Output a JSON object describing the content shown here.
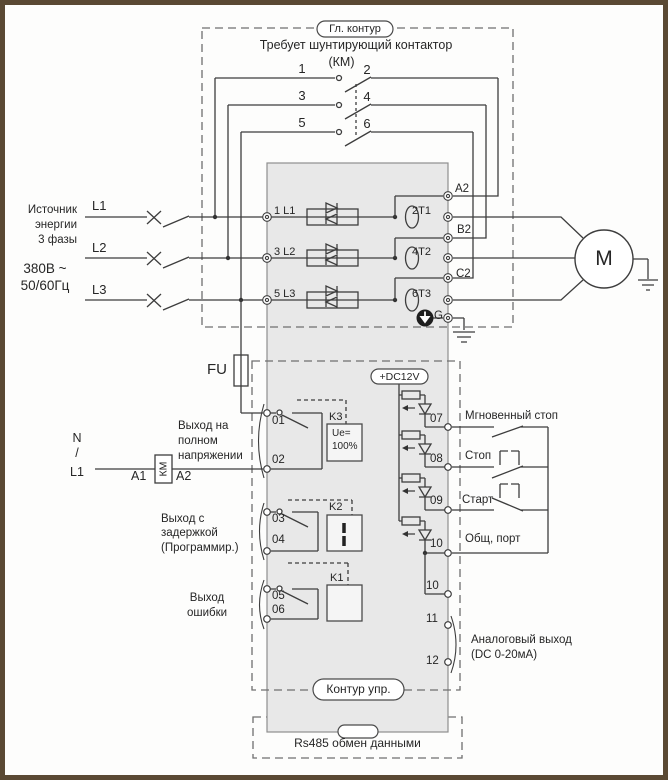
{
  "main_circuit": {
    "pill": "Гл. контур",
    "note1": "Требует шунтирующий контактор",
    "note2": "(КМ)",
    "contacts": [
      "1",
      "2",
      "3",
      "4",
      "5",
      "6"
    ]
  },
  "source": {
    "lines": [
      "Источник",
      "энергии",
      "3 фазы"
    ],
    "voltage": "380В ~",
    "freq": "50/60Гц",
    "phases": [
      "L1",
      "L2",
      "L3"
    ]
  },
  "power": {
    "inputs": [
      "1 L1",
      "3 L2",
      "5 L3"
    ],
    "outputs": [
      "2T1",
      "4T2",
      "6T3"
    ],
    "bypass": [
      "A2",
      "B2",
      "C2"
    ],
    "ground": "G",
    "motor": "M",
    "fuse": "FU"
  },
  "control": {
    "pill": "Контур упр.",
    "dc": "+DC12V",
    "supply": [
      "N",
      "/",
      "L1"
    ],
    "km": {
      "a1": "A1",
      "label": "КМ",
      "a2": "A2"
    },
    "out1": {
      "t1": "01",
      "t2": "02",
      "k": "K3",
      "box1": "Ue=",
      "box2": "100%",
      "desc": [
        "Выход на",
        "полном",
        "напряжении"
      ]
    },
    "out2": {
      "t1": "03",
      "t2": "04",
      "k": "K2",
      "desc": [
        "Выход с",
        "задержкой",
        "(Программир.)"
      ]
    },
    "out3": {
      "t1": "05",
      "t2": "06",
      "k": "K1",
      "desc": [
        "Выход",
        "ошибки"
      ]
    },
    "in07": {
      "t": "07",
      "label": "Мгновенный стоп"
    },
    "in08": {
      "t": "08",
      "label": "Стоп"
    },
    "in09": {
      "t": "09",
      "label": "Старт"
    },
    "in10": {
      "t": "10",
      "label": "Общ, порт"
    },
    "t10b": "10",
    "t11": "11",
    "t12": "12",
    "analog": [
      "Аналоговый выход",
      "(DC 0-20мА)"
    ]
  },
  "rs485": "Rs485 обмен данными",
  "colors": {
    "wire": "#3d3d3d",
    "block": "#e8e8e8",
    "frame": "#5a4933"
  }
}
